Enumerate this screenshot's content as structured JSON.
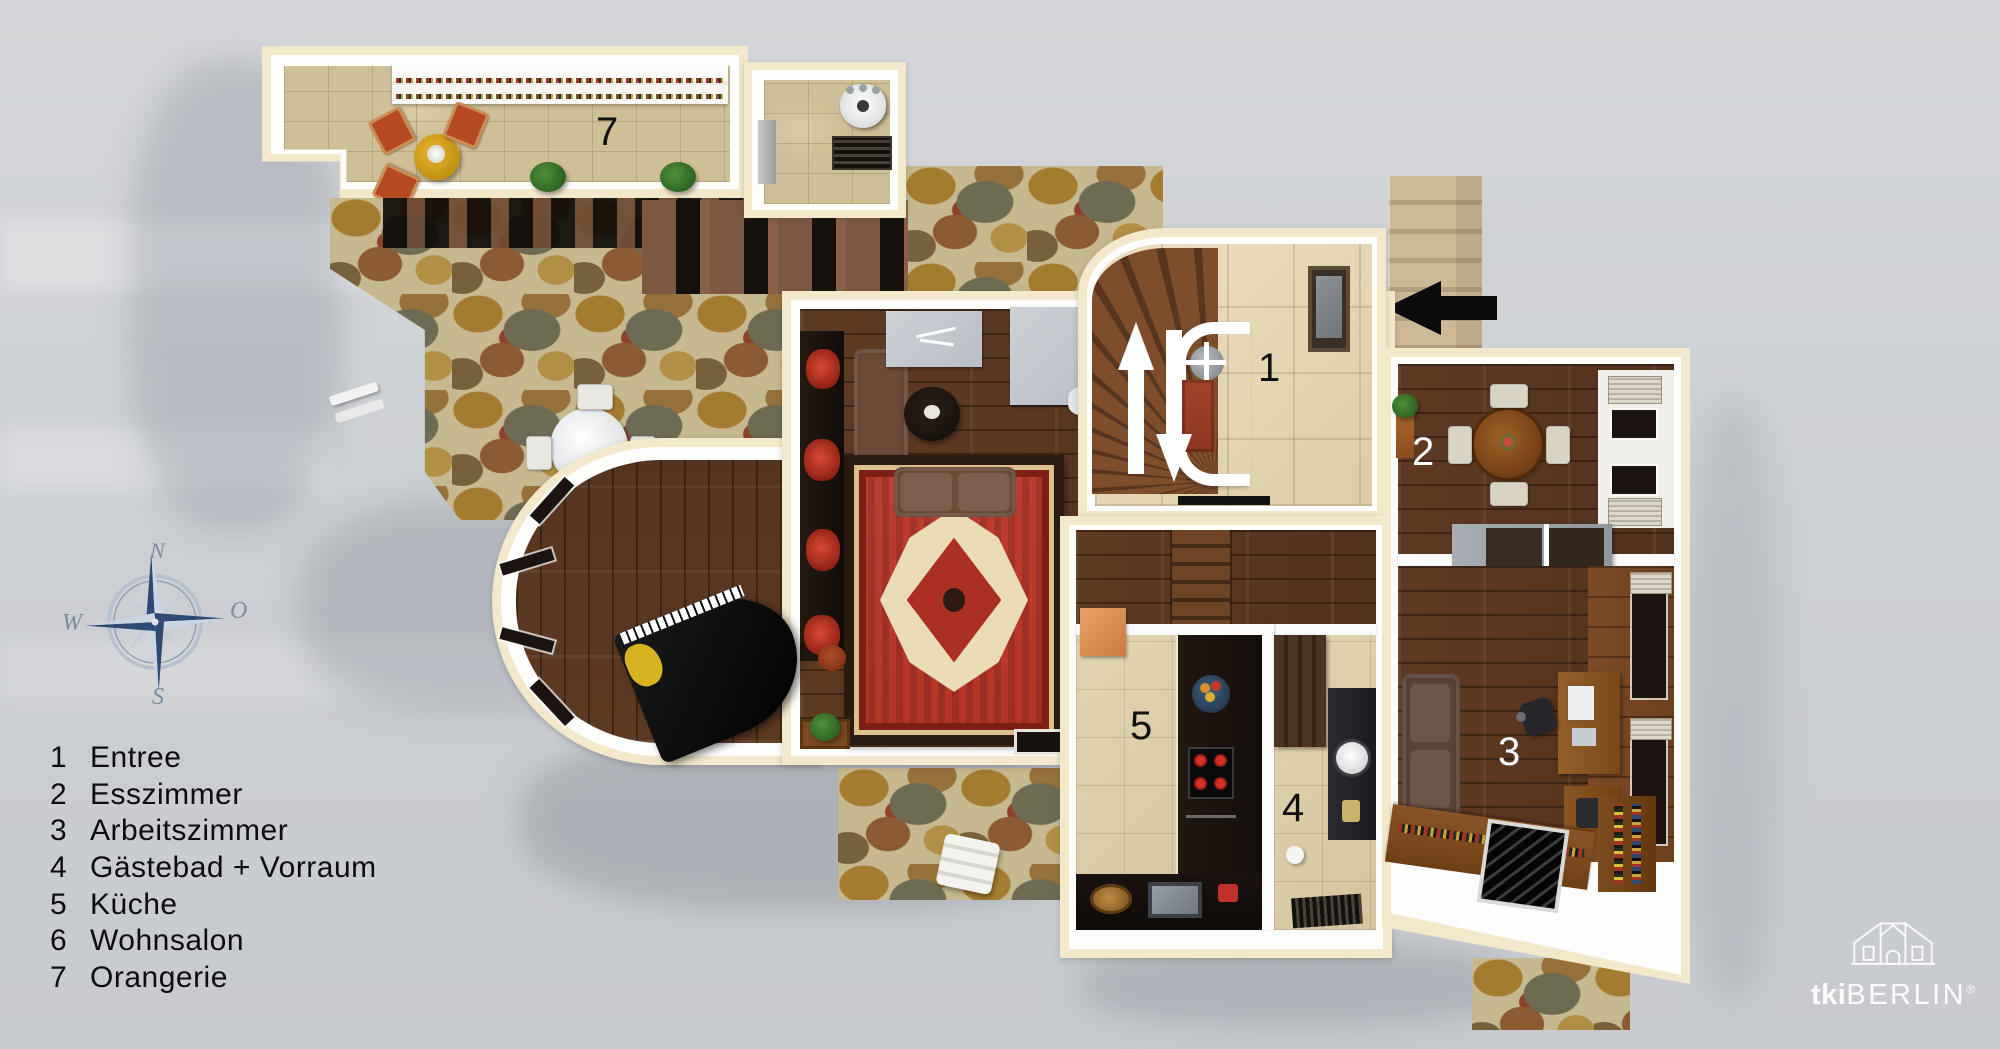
{
  "title": "3D Grundriss Erdgeschoss",
  "rooms": [
    {
      "number": "1",
      "name": "Entree"
    },
    {
      "number": "2",
      "name": "Esszimmer"
    },
    {
      "number": "3",
      "name": "Arbeitszimmer"
    },
    {
      "number": "4",
      "name": "Gästebad + Vorraum"
    },
    {
      "number": "5",
      "name": "Küche"
    },
    {
      "number": "6",
      "name": "Wohnsalon"
    },
    {
      "number": "7",
      "name": "Orangerie"
    }
  ],
  "legend": {
    "items": [
      {
        "number": "1",
        "label": "Entree"
      },
      {
        "number": "2",
        "label": "Esszimmer"
      },
      {
        "number": "3",
        "label": "Arbeitszimmer"
      },
      {
        "number": "4",
        "label": "Gästebad + Vorraum"
      },
      {
        "number": "5",
        "label": "Küche"
      },
      {
        "number": "6",
        "label": "Wohnsalon"
      },
      {
        "number": "7",
        "label": "Orangerie"
      }
    ]
  },
  "compass": {
    "north": "N",
    "east": "O",
    "south": "S",
    "west": "W"
  },
  "entrance_arrow": {
    "direction": "left"
  },
  "brand": {
    "bold": "tki",
    "light": "BERLIN",
    "registered": "®"
  },
  "palette": {
    "background": "#cdd0d4",
    "wall_cream": "#f4e8cb",
    "wall_white": "#fdfdfc",
    "flagstone": "#c6b88f",
    "wood_dark": "#5e3a23",
    "tile_beige": "#e2d4b2",
    "rug_red": "#bf3e33",
    "arrow_black": "#0b0b0b",
    "compass_blue": "#2e4a74",
    "label_dark": "#101010",
    "label_light": "#ffffff"
  }
}
